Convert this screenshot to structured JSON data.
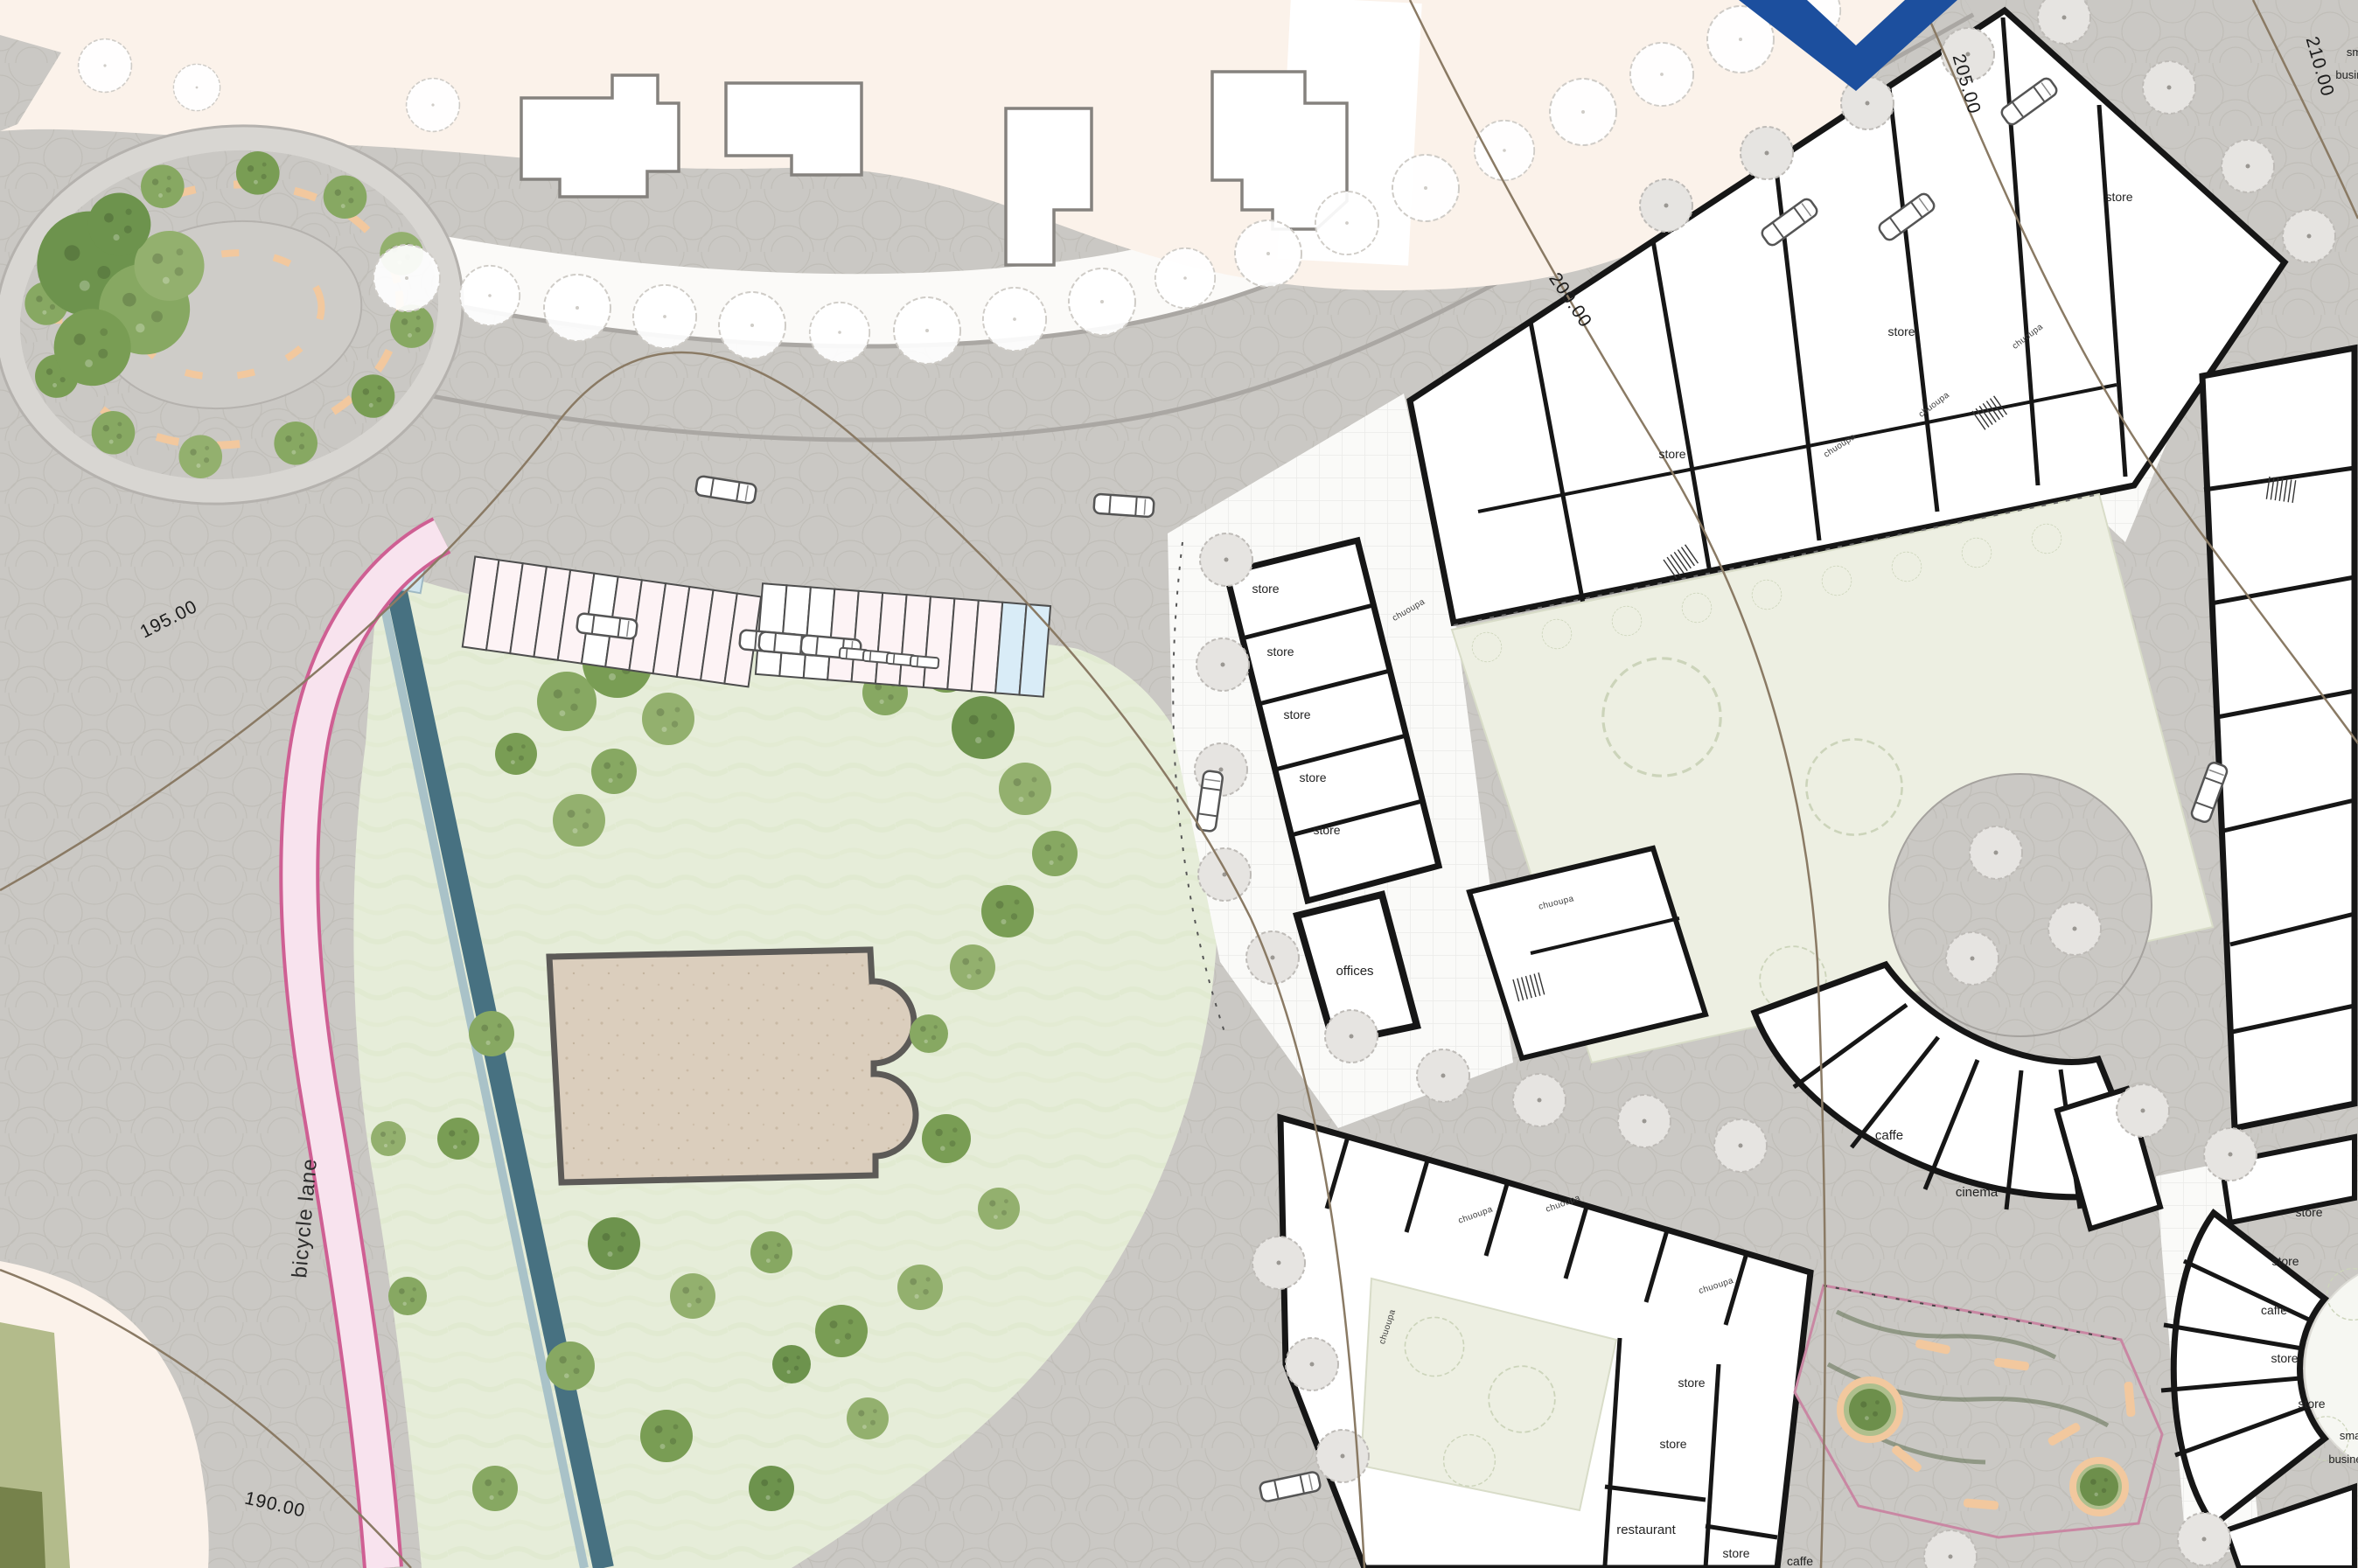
{
  "plan": {
    "title": "urban district site plan",
    "contours": {
      "c190": "190.00",
      "c195": "195.00",
      "c200": "200.00",
      "c205": "205.00",
      "c210": "210.00"
    },
    "park": {
      "bicycle_lane": "bicycle lane"
    },
    "corridor_label": "chuoupa",
    "blocks": {
      "north_shops": {
        "store_1": "store",
        "store_2": "store",
        "store_3": "store"
      },
      "west_row": {
        "stores": [
          "store",
          "store",
          "store",
          "store",
          "store"
        ],
        "offices": "offices"
      },
      "fan_building": {
        "caffe": "caffe",
        "cinema": "cinema"
      },
      "south_block": {
        "store_1": "store",
        "store_2": "store",
        "restaurant": "restaurant",
        "store_3": "store",
        "caffe": "caffe"
      },
      "east_fan": {
        "store_1": "store",
        "store_2": "store",
        "caffe": "caffe",
        "store_3": "store",
        "store_4": "store",
        "small_business_1": "small",
        "small_business_2": "business"
      },
      "northeast_edge": {
        "small_business_1": "small",
        "small_business_2": "business"
      }
    },
    "parking": {
      "stall_count": 24,
      "accessible_stall_count": 2
    },
    "colors": {
      "bicycle_lane_pink": "#f8e3ee",
      "bicycle_lane_edge": "#cf5f93",
      "water_channel": "#477181",
      "contour_line": "#8a7a64",
      "bench_peach": "#f2c89e",
      "logo_blue": "#1c4f9e",
      "park_green": "#e6edd9",
      "tree_green": "#87a862"
    }
  }
}
